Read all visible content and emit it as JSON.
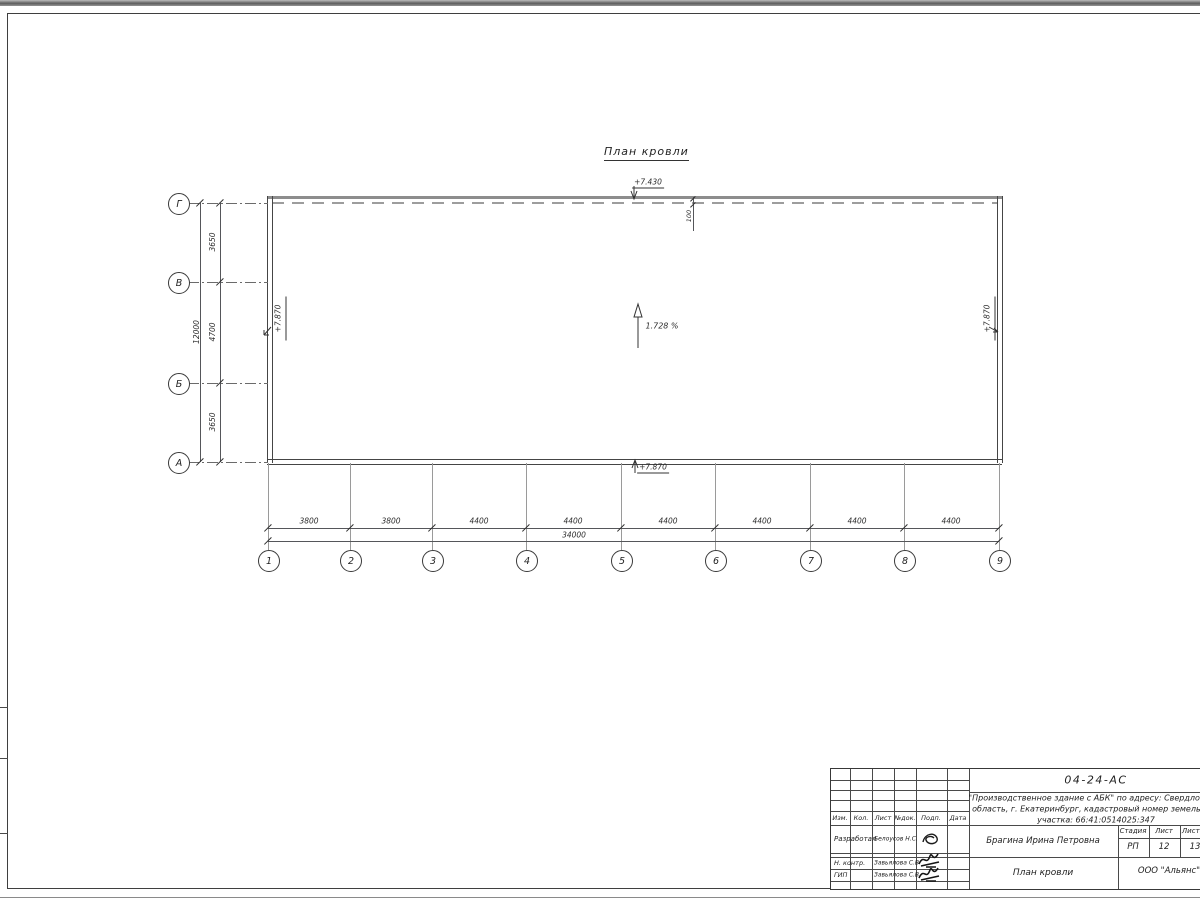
{
  "drawing": {
    "title": "План кровли",
    "roof": {
      "top_elevation": "+7.430",
      "parapet_offset": "100",
      "left_elevation": "+7.870",
      "right_elevation": "+7.870",
      "bottom_elevation": "+7.870",
      "slope": "1.728 %"
    },
    "axes": {
      "horizontal_letters": [
        "Г",
        "В",
        "Б",
        "А"
      ],
      "vertical_numbers": [
        "1",
        "2",
        "3",
        "4",
        "5",
        "6",
        "7",
        "8",
        "9"
      ],
      "left_dims": [
        "3650",
        "4700",
        "3650"
      ],
      "left_total": "12000",
      "bottom_dims": [
        "3800",
        "3800",
        "4400",
        "4400",
        "4400",
        "4400",
        "4400",
        "4400"
      ],
      "bottom_total": "34000"
    }
  },
  "title_block": {
    "doc_number": "04-24-АС",
    "project_line1": "\"Производственное здание с АБК\" по адресу: Свердловская",
    "project_line2": "область, г. Екатеринбург, кадастровый номер земельного",
    "project_line3": "участка: 66:41:0514025:347",
    "columns": [
      "Изм.",
      "Кол.",
      "Лист",
      "№док.",
      "Подп.",
      "Дата"
    ],
    "rows": [
      {
        "role": "Разработал",
        "name": "Белоусов Н.С."
      },
      {
        "role": "Н. контр.",
        "name": "Завьялова С.В"
      },
      {
        "role": "ГИП",
        "name": "Завьялова С.В"
      }
    ],
    "client": "Брагина Ирина Петровна",
    "stage_header": [
      "Стадия",
      "Лист",
      "Листов"
    ],
    "stage_value": "РП",
    "sheet_value": "12",
    "sheets_value": "13",
    "sheet_title": "План кровли",
    "company": "ООО \"Альянс\""
  },
  "colors": {
    "line": "#3c3c3c",
    "roof_edge": "#8d8d8d",
    "dash": "#9d9d9d"
  }
}
